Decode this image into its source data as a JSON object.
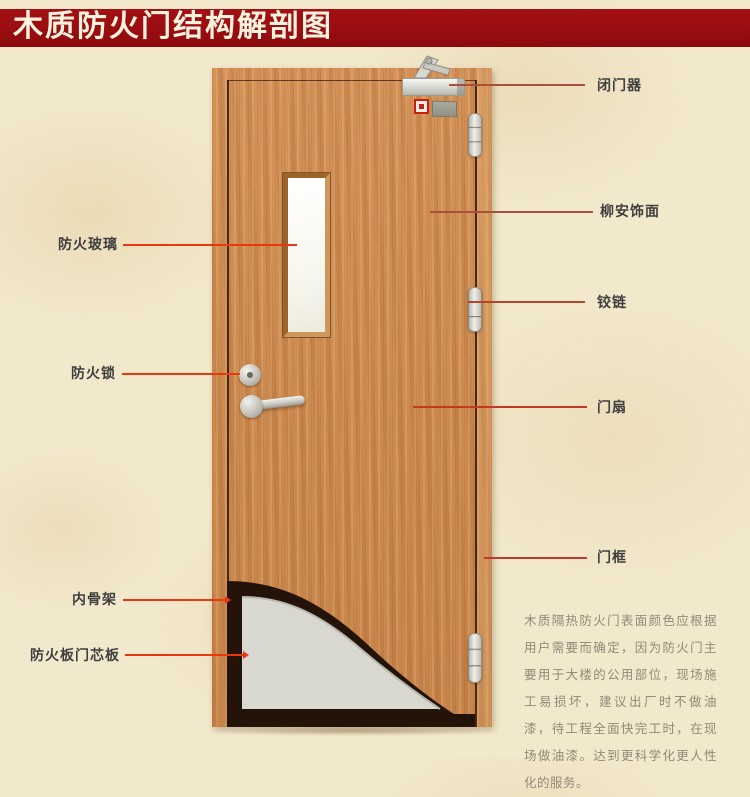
{
  "title": "木质防火门结构解剖图",
  "labels": {
    "left": [
      {
        "text": "防火玻璃"
      },
      {
        "text": "防火锁"
      },
      {
        "text": "内骨架"
      },
      {
        "text": "防火板门芯板"
      }
    ],
    "right": [
      {
        "text": "闭门器"
      },
      {
        "text": "柳安饰面"
      },
      {
        "text": "铰链"
      },
      {
        "text": "门扇"
      },
      {
        "text": "门框"
      }
    ]
  },
  "note": {
    "text": "木质隔热防火门表面颜色应根据用户需要而确定，因为防火门主要用于大楼的公用部位，现场施工易损坏，建议出厂时不做油漆，待工程全面快完工时，在现场做油漆。达到更科学化更人性化的服务。"
  },
  "colors": {
    "banner_red": "#9a0d10",
    "leader_bright_red": "#e8380d",
    "leader_dark_red": "#a8503c",
    "label_text": "#3f3f3f",
    "note_text": "#92897a",
    "door_wood": "#cd8a4e",
    "core_board_gray": "#d9d8d0",
    "inner_skeleton_dark": "#241309"
  }
}
